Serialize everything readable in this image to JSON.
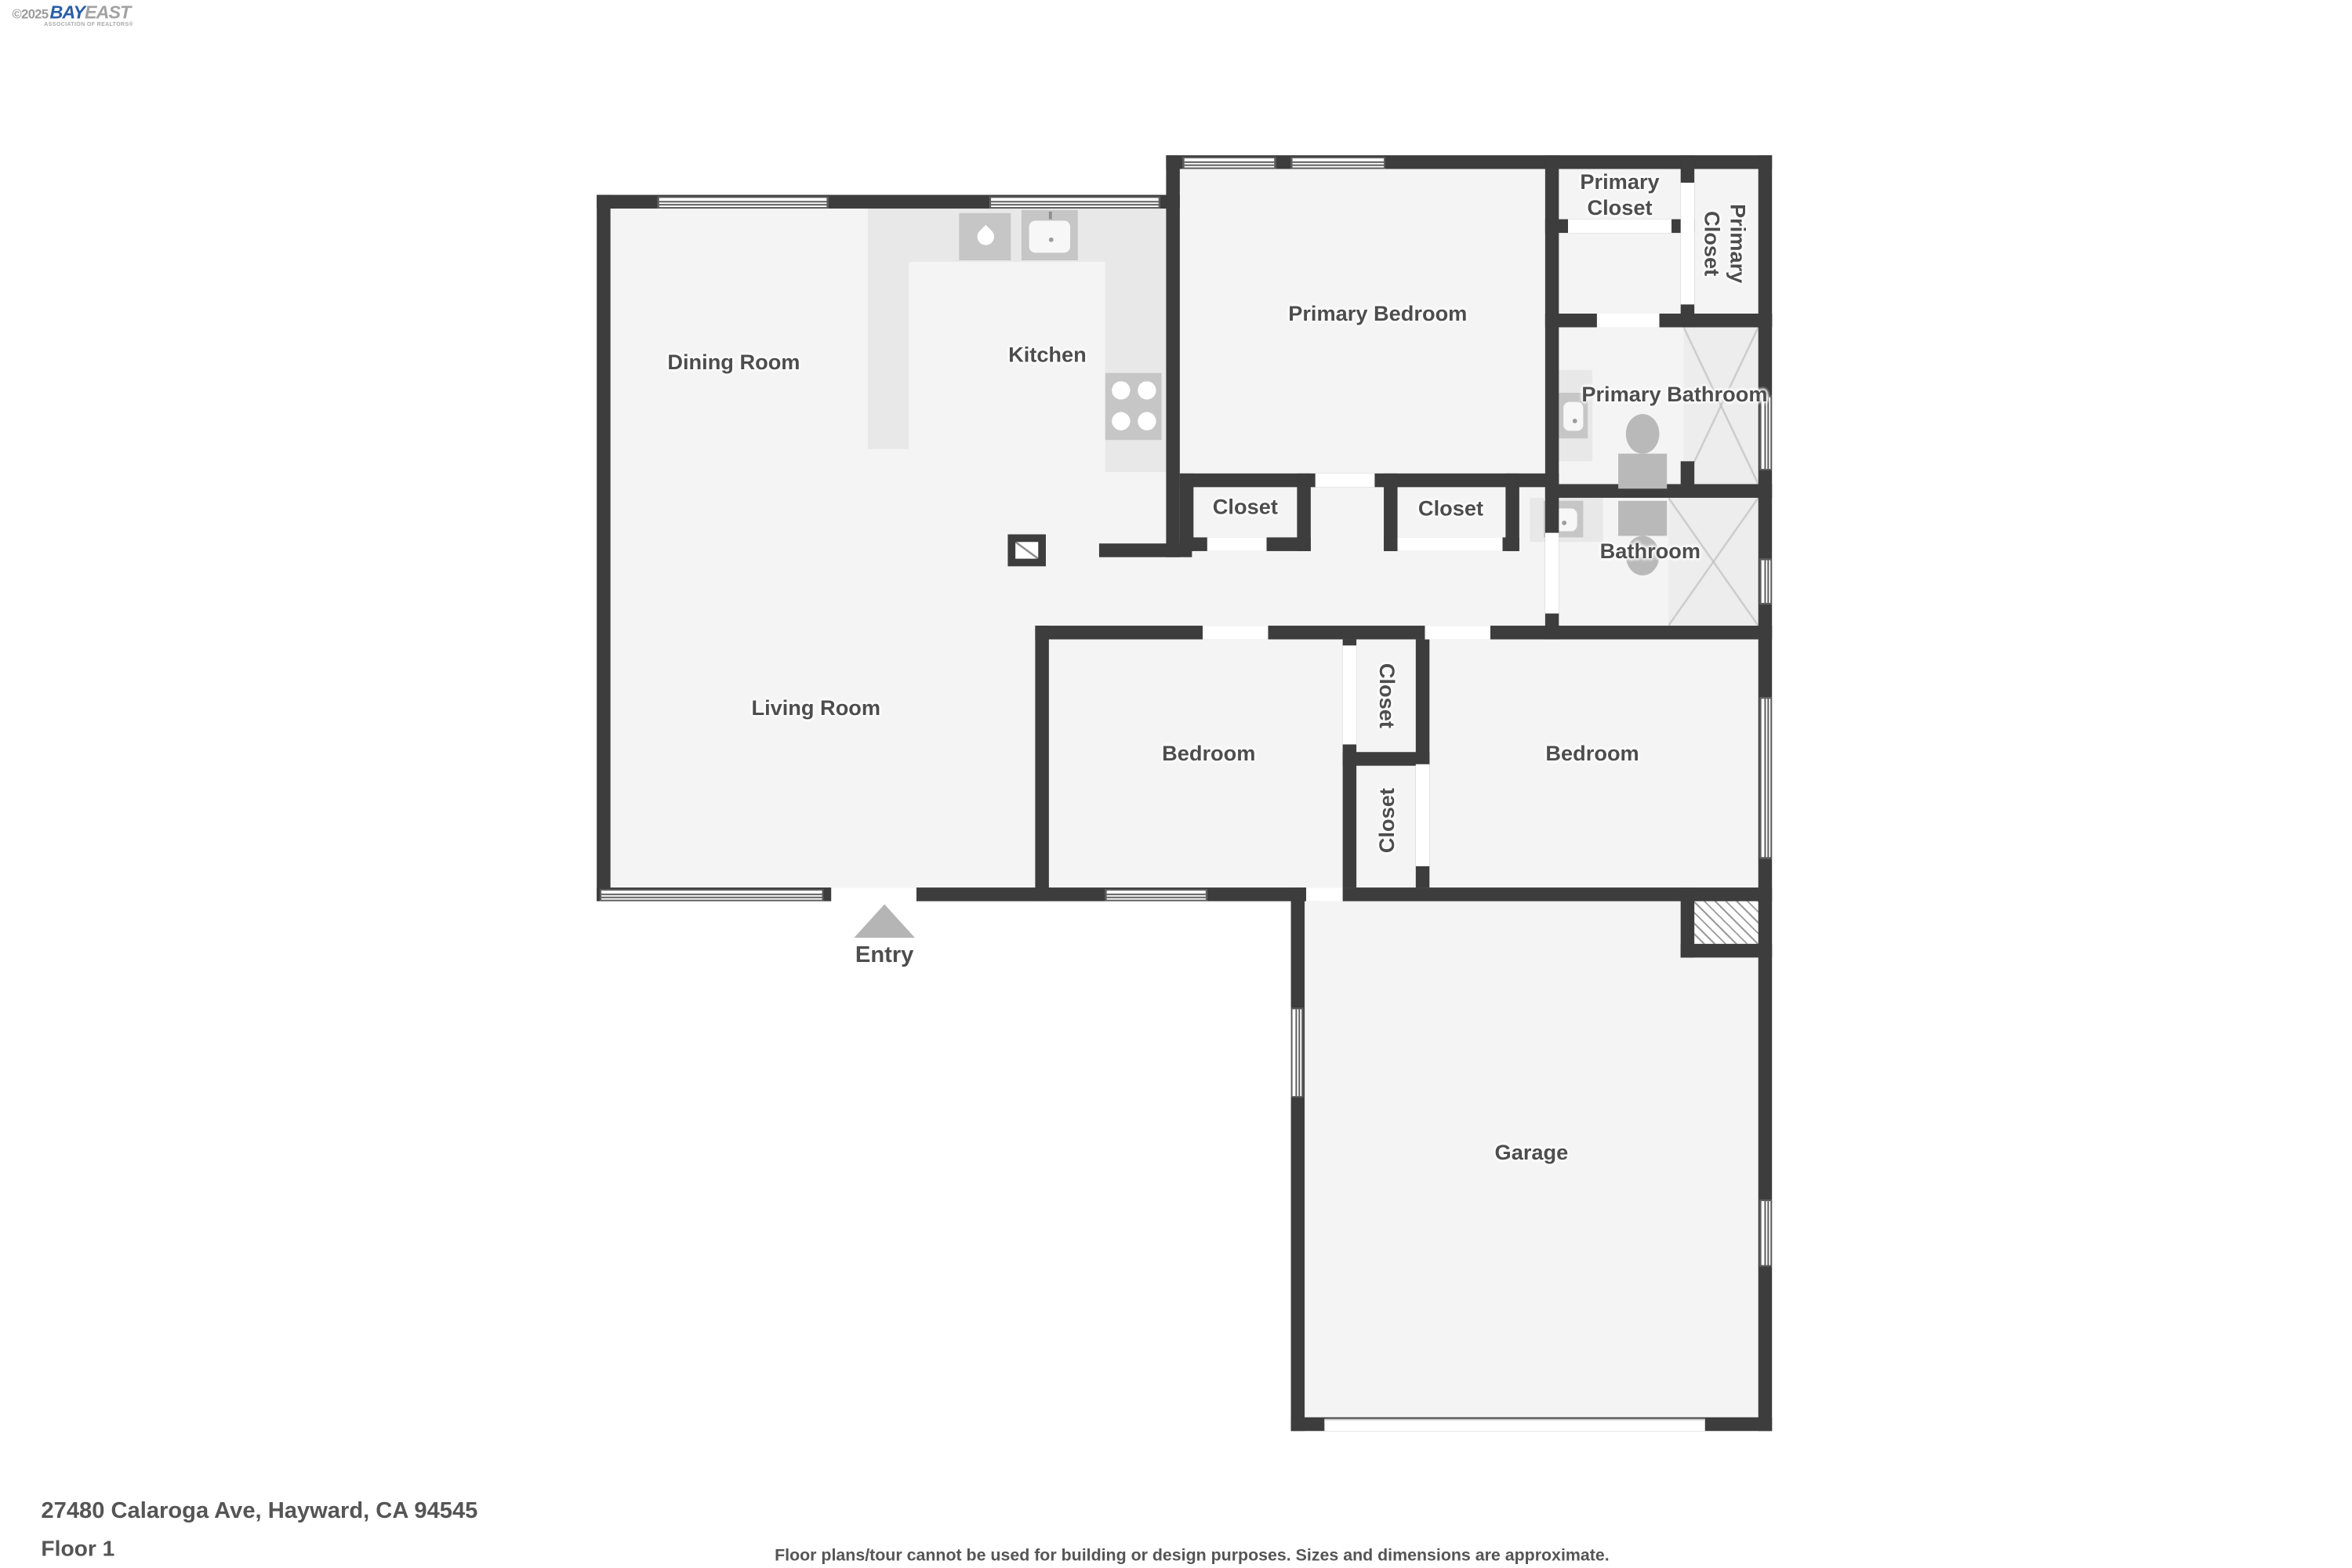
{
  "logo": {
    "copyright": "©2025",
    "brand_primary": "BAY",
    "brand_secondary": "EAST",
    "tagline": "ASSOCIATION OF REALTORS®"
  },
  "floorplan": {
    "rooms": {
      "dining_room": "Dining Room",
      "kitchen": "Kitchen",
      "primary_bedroom": "Primary Bedroom",
      "primary_closet": "Primary Closet",
      "primary_closet_side": "Primary Closet",
      "primary_bathroom": "Primary Bathroom",
      "hall_closet_left": "Closet",
      "hall_closet_right": "Closet",
      "bathroom": "Bathroom",
      "living_room": "Living Room",
      "bedroom_left": "Bedroom",
      "bedroom_closet_top": "Closet",
      "bedroom_closet_bottom": "Closet",
      "bedroom_right": "Bedroom",
      "garage": "Garage",
      "entry": "Entry"
    },
    "icons": {
      "entry_arrow": "up-triangle",
      "water_drop": "drop",
      "stove_burners": "four-circles",
      "shower_pattern": "x-cross",
      "water_heater_pattern": "diagonal-hatch"
    },
    "colors": {
      "wall": "#3d3d3d",
      "floor": "#f4f4f4",
      "counter": "#e8e8e8",
      "fixture": "#c6c6c6",
      "fixture_dark": "#b9b9b9",
      "label": "#4d4d4d",
      "shower": "#ededed",
      "shower_line": "#c2c2c2",
      "entry": "#b5b5b5",
      "brand_blue": "#2b5ea7",
      "brand_gray": "#a3a3a3"
    }
  },
  "footer": {
    "address": "27480 Calaroga Ave, Hayward, CA 94545",
    "floor_label": "Floor 1",
    "disclaimer": "Floor plans/tour cannot be used for building or design purposes. Sizes and dimensions are approximate."
  }
}
